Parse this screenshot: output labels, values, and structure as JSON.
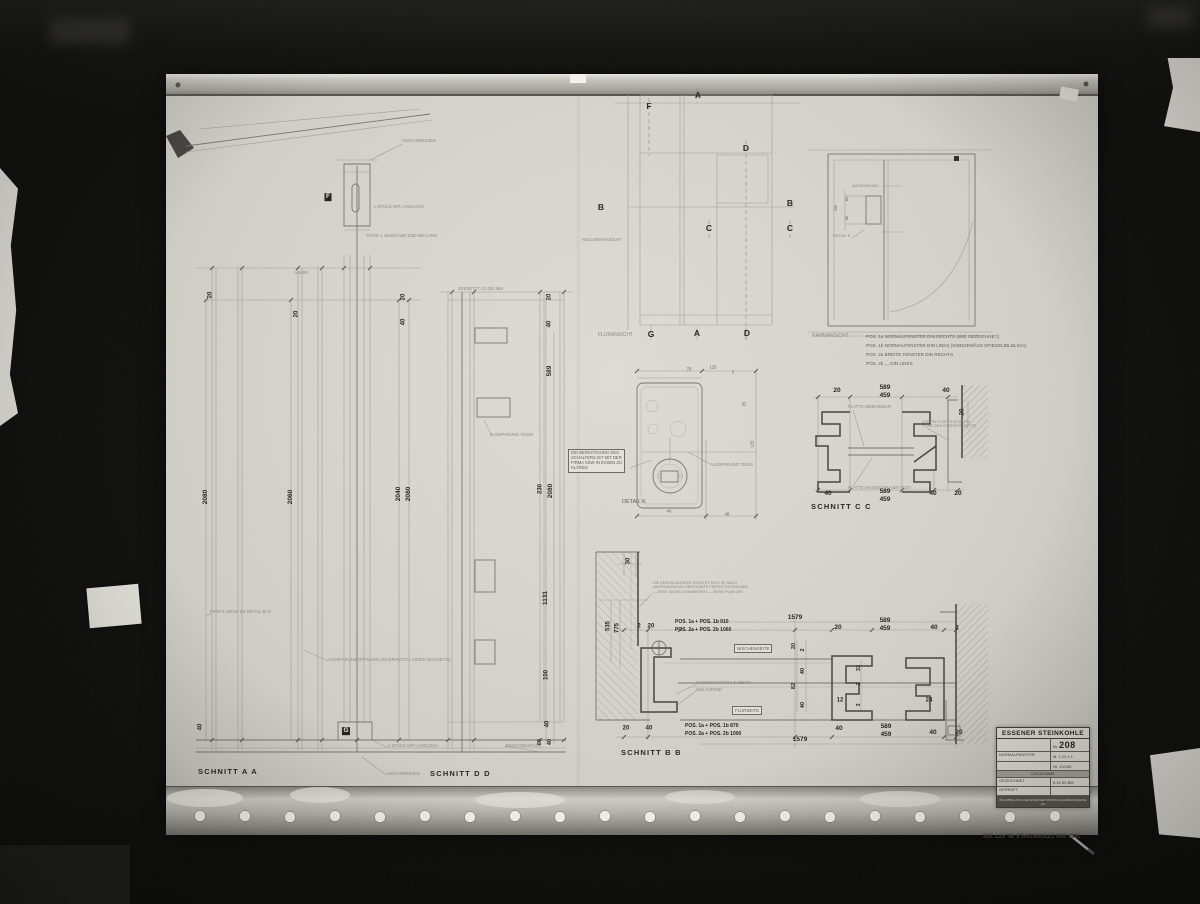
{
  "title_block": {
    "company": "ESSENER STEINKOHLE",
    "number_label": "Nr.",
    "number": "208",
    "name": "NORMALFENSTER",
    "scale": "M. 1:10  1:1",
    "ref": "Nr. 20/158",
    "band": "DATUM        NAME",
    "drawn_label": "GEZEICHNET",
    "drawn_value": "6.10.53   BM",
    "checked_label": "GEPRÜFT",
    "checked_value": "",
    "footer": "BAUABTEILUNG DER ESSENER STEINKOHLENBERGWERKE AG"
  },
  "labels": [
    {
      "t": "SCHNITT  A  A",
      "x": 198,
      "y": 768,
      "s": 7.5,
      "w": 1,
      "ls": 1.2,
      "n": "schnitt-a-a-title"
    },
    {
      "t": "SCHNITT  D  D",
      "x": 430,
      "y": 770,
      "s": 7.5,
      "w": 1,
      "ls": 1.2,
      "n": "schnitt-d-d-title"
    },
    {
      "t": "SCHNITT  B  B",
      "x": 621,
      "y": 749,
      "s": 7.5,
      "w": 1,
      "ls": 1.2,
      "n": "schnitt-b-b-title"
    },
    {
      "t": "SCHNITT  C  C",
      "x": 811,
      "y": 503,
      "s": 7.5,
      "w": 1,
      "ls": 1.2,
      "n": "schnitt-c-c-title"
    },
    {
      "t": "FLURANSICHT",
      "x": 598,
      "y": 333,
      "s": 5,
      "c": "faint",
      "n": "fluransicht-label"
    },
    {
      "t": "RAHMANSICHT",
      "x": 812,
      "y": 334,
      "s": 5,
      "c": "faint",
      "n": "rahmansicht-label"
    },
    {
      "t": "NISCHENANSICHT",
      "x": 582,
      "y": 237,
      "s": 4.5,
      "c": "faint",
      "n": "nischenansicht-label"
    },
    {
      "t": "DETAIL  K",
      "x": 622,
      "y": 499,
      "s": 5.5,
      "c": "mid",
      "n": "detail-k-label"
    },
    {
      "t": "DETAIL K",
      "x": 833,
      "y": 234,
      "s": 4,
      "c": "faint"
    },
    {
      "t": "AUSSPARUNG",
      "x": 852,
      "y": 184,
      "s": 3.8,
      "c": "faint"
    },
    {
      "t": "AUSSPARUNG 75/150",
      "x": 710,
      "y": 463,
      "s": 4.2,
      "c": "faint"
    },
    {
      "t": "AUSSPARUNG 75/150",
      "x": 490,
      "y": 433,
      "s": 4.2,
      "c": "faint"
    },
    {
      "t": "POS. 1a  NORMALFENSTER   DIN RECHTS   (WIE GEZEICHNET)",
      "x": 866,
      "y": 334,
      "s": 4.6,
      "c": "mid"
    },
    {
      "t": "POS. 1b  NORMALFENSTER   DIN LINKS    (SINNGEMÄSS SPIEGELBILDLICH)",
      "x": 866,
      "y": 343,
      "s": 4.6,
      "c": "mid"
    },
    {
      "t": "POS. 2a  BREITE FENSTER   DIN RECHTS",
      "x": 866,
      "y": 352,
      "s": 4.6,
      "c": "mid"
    },
    {
      "t": "POS. 2b       „            „          DIN LINKS",
      "x": 866,
      "y": 361,
      "s": 4.6,
      "c": "mid"
    },
    {
      "t": "DIE BEFESTIGUNG DES\nSCHALTERS IST MIT DER\nFIRMA SSW IN ESSEN ZU\nKLÄREN",
      "x": 568,
      "y": 449,
      "s": 4.2,
      "c": "mid",
      "box": 1,
      "n": "note-befestigung"
    },
    {
      "t": "DIE ANSCHLAGHÖHE RICHTET SICH JE NACH\nANORDNUNG AB OBERKANTE FERTIG FUSSBODEN\n— ERST AM BAU EINMESSEN —   SIEHE PLAN 206",
      "x": 653,
      "y": 581,
      "s": 3.8,
      "c": "faint",
      "n": "note-anschlag"
    },
    {
      "t": "GUMMIDICHTUNG   5-SEITIG",
      "x": 696,
      "y": 681,
      "s": 4.2,
      "c": "faint"
    },
    {
      "t": "UMLAUFEND",
      "x": 696,
      "y": 688,
      "s": 4.2,
      "c": "faint"
    },
    {
      "t": "NISCHENSEITE",
      "x": 734,
      "y": 644,
      "s": 4.4,
      "c": "mid",
      "box": 1
    },
    {
      "t": "FLURSEITE",
      "x": 732,
      "y": 706,
      "s": 4.4,
      "c": "mid",
      "box": 1
    },
    {
      "t": "PLATTE ABNEHMBAR",
      "x": 848,
      "y": 405,
      "s": 4.2,
      "c": "faint"
    },
    {
      "t": "PLATTE ANGESCHRAUBT FEST",
      "x": 848,
      "y": 486,
      "s": 4.2,
      "c": "faint"
    },
    {
      "t": "ASBEST-PLATTE 20 MM IN\nHÖHE DES KÖRPERS (MITTE)",
      "x": 922,
      "y": 420,
      "s": 3.8,
      "c": "faint"
    },
    {
      "t": "ANSCHWEISSEN",
      "x": 402,
      "y": 139,
      "s": 4.2,
      "c": "faint"
    },
    {
      "t": "ANSCHWEISSEN",
      "x": 386,
      "y": 772,
      "s": 4.2,
      "c": "faint"
    },
    {
      "t": "L-STÜCK MIT LANGLOCH",
      "x": 374,
      "y": 205,
      "s": 4.2,
      "c": "faint"
    },
    {
      "t": "STAHL-L 45/45/4 MM    1350 MM LANG",
      "x": 366,
      "y": 234,
      "s": 4.2,
      "c": "faint"
    },
    {
      "t": "L-STÜCK MIT LANGLOCH",
      "x": 388,
      "y": 744,
      "s": 4.2,
      "c": "faint"
    },
    {
      "t": "ZWISCHENSTÜCK",
      "x": 505,
      "y": 744,
      "s": 4.2,
      "c": "faint"
    },
    {
      "t": "VERSETZT CA 300 MM",
      "x": 458,
      "y": 287,
      "s": 4.2,
      "c": "faint"
    },
    {
      "t": "ANKER",
      "x": 294,
      "y": 271,
      "s": 4.2,
      "c": "faint"
    },
    {
      "t": "PROFIL SIEHE ZU DETAIL 45 G",
      "x": 210,
      "y": 610,
      "s": 4.2,
      "c": "faint"
    },
    {
      "t": "AUSSPARUNG ÖFFNUNG UNVERPUTZT LASSEN (BAUSEITS)",
      "x": 328,
      "y": 658,
      "s": 4.2,
      "c": "faint"
    },
    {
      "t": "POS. 1a + POS. 1b    910",
      "x": 675,
      "y": 620,
      "s": 5,
      "w": 1
    },
    {
      "t": "POS. 2a + POS. 2b   1060",
      "x": 675,
      "y": 628,
      "s": 5,
      "w": 1
    },
    {
      "t": "POS. 1a + POS. 1b    870",
      "x": 685,
      "y": 724,
      "s": 5,
      "w": 1
    },
    {
      "t": "POS. 2a + POS. 2b   1000",
      "x": 685,
      "y": 732,
      "s": 5,
      "w": 1
    },
    {
      "t": "2080",
      "x": 206,
      "y": 497,
      "s": 6.5,
      "w": 1,
      "ctr": 1,
      "r": -90
    },
    {
      "t": "2060",
      "x": 291,
      "y": 497,
      "s": 6.5,
      "w": 1,
      "ctr": 1,
      "r": -90
    },
    {
      "t": "2040",
      "x": 399,
      "y": 494,
      "s": 6.5,
      "w": 1,
      "ctr": 1,
      "r": -90
    },
    {
      "t": "2080",
      "x": 409,
      "y": 494,
      "s": 6.5,
      "w": 1,
      "ctr": 1,
      "r": -90
    },
    {
      "t": "20",
      "x": 211,
      "y": 295,
      "s": 6,
      "w": 1,
      "ctr": 1,
      "r": -90
    },
    {
      "t": "20",
      "x": 297,
      "y": 314,
      "s": 6,
      "w": 1,
      "ctr": 1,
      "r": -90
    },
    {
      "t": "20",
      "x": 404,
      "y": 297,
      "s": 6,
      "w": 1,
      "ctr": 1,
      "r": -90
    },
    {
      "t": "40",
      "x": 404,
      "y": 322,
      "s": 6,
      "w": 1,
      "ctr": 1,
      "r": -90
    },
    {
      "t": "40",
      "x": 201,
      "y": 727,
      "s": 6,
      "w": 1,
      "ctr": 1,
      "r": -90
    },
    {
      "t": "20",
      "x": 550,
      "y": 297,
      "s": 6,
      "w": 1,
      "ctr": 1,
      "r": -90
    },
    {
      "t": "40",
      "x": 550,
      "y": 324,
      "s": 6,
      "w": 1,
      "ctr": 1,
      "r": -90
    },
    {
      "t": "589",
      "x": 550,
      "y": 371,
      "s": 6.5,
      "w": 1,
      "ctr": 1,
      "r": -90
    },
    {
      "t": "230",
      "x": 541,
      "y": 489,
      "s": 6,
      "w": 1,
      "ctr": 1,
      "r": -90
    },
    {
      "t": "2080",
      "x": 551,
      "y": 491,
      "s": 6.5,
      "w": 1,
      "ctr": 1,
      "r": -90
    },
    {
      "t": "1131",
      "x": 546,
      "y": 598,
      "s": 6.5,
      "w": 1,
      "ctr": 1,
      "r": -90
    },
    {
      "t": "100",
      "x": 547,
      "y": 675,
      "s": 6,
      "w": 1,
      "ctr": 1,
      "r": -90
    },
    {
      "t": "40",
      "x": 548,
      "y": 724,
      "s": 6,
      "w": 1,
      "ctr": 1,
      "r": -90
    },
    {
      "t": "60",
      "x": 540,
      "y": 742,
      "s": 5.5,
      "w": 1,
      "ctr": 1,
      "r": -90
    },
    {
      "t": "40",
      "x": 550,
      "y": 742,
      "s": 5.5,
      "w": 1,
      "ctr": 1,
      "r": -90
    },
    {
      "t": "535",
      "x": 609,
      "y": 626,
      "s": 6,
      "w": 1,
      "ctr": 1,
      "r": -90
    },
    {
      "t": "775",
      "x": 618,
      "y": 628,
      "s": 6,
      "w": 1,
      "ctr": 1,
      "r": -90
    },
    {
      "t": "30",
      "x": 629,
      "y": 561,
      "s": 6,
      "w": 1,
      "ctr": 1,
      "r": -90
    },
    {
      "t": "20",
      "x": 837,
      "y": 391,
      "s": 6.5,
      "w": 1,
      "ctr": 1
    },
    {
      "t": "589",
      "x": 885,
      "y": 388,
      "s": 6.5,
      "w": 1,
      "ctr": 1
    },
    {
      "t": "459",
      "x": 885,
      "y": 396,
      "s": 6.5,
      "w": 1,
      "ctr": 1
    },
    {
      "t": "40",
      "x": 946,
      "y": 391,
      "s": 6.5,
      "w": 1,
      "ctr": 1
    },
    {
      "t": "20",
      "x": 963,
      "y": 412,
      "s": 6,
      "w": 1,
      "ctr": 1,
      "r": -90
    },
    {
      "t": "40",
      "x": 828,
      "y": 494,
      "s": 6.5,
      "w": 1,
      "ctr": 1
    },
    {
      "t": "589",
      "x": 885,
      "y": 492,
      "s": 6.5,
      "w": 1,
      "ctr": 1
    },
    {
      "t": "459",
      "x": 885,
      "y": 500,
      "s": 6.5,
      "w": 1,
      "ctr": 1
    },
    {
      "t": "40",
      "x": 933,
      "y": 494,
      "s": 6.5,
      "w": 1,
      "ctr": 1
    },
    {
      "t": "20",
      "x": 958,
      "y": 494,
      "s": 6.5,
      "w": 1,
      "ctr": 1
    },
    {
      "t": "2",
      "x": 639,
      "y": 627,
      "s": 6,
      "w": 1,
      "ctr": 1
    },
    {
      "t": "20",
      "x": 651,
      "y": 627,
      "s": 6,
      "w": 1,
      "ctr": 1
    },
    {
      "t": "1579",
      "x": 795,
      "y": 618,
      "s": 6.5,
      "w": 1,
      "ctr": 1
    },
    {
      "t": "20",
      "x": 838,
      "y": 628,
      "s": 6.5,
      "w": 1,
      "ctr": 1
    },
    {
      "t": "589",
      "x": 885,
      "y": 621,
      "s": 6.5,
      "w": 1,
      "ctr": 1
    },
    {
      "t": "459",
      "x": 885,
      "y": 629,
      "s": 6.5,
      "w": 1,
      "ctr": 1
    },
    {
      "t": "40",
      "x": 934,
      "y": 628,
      "s": 6.5,
      "w": 1,
      "ctr": 1
    },
    {
      "t": "2",
      "x": 957,
      "y": 629,
      "s": 6,
      "w": 1,
      "ctr": 1
    },
    {
      "t": "20",
      "x": 794,
      "y": 646,
      "s": 5.5,
      "w": 1,
      "ctr": 1,
      "r": -90
    },
    {
      "t": "2",
      "x": 803,
      "y": 650,
      "s": 5.5,
      "w": 1,
      "ctr": 1,
      "r": -90
    },
    {
      "t": "40",
      "x": 803,
      "y": 671,
      "s": 5.5,
      "w": 1,
      "ctr": 1,
      "r": -90
    },
    {
      "t": "82",
      "x": 794,
      "y": 686,
      "s": 5.5,
      "w": 1,
      "ctr": 1,
      "r": -90
    },
    {
      "t": "40",
      "x": 803,
      "y": 705,
      "s": 5.5,
      "w": 1,
      "ctr": 1,
      "r": -90
    },
    {
      "t": "33",
      "x": 859,
      "y": 668,
      "s": 5.5,
      "w": 1,
      "ctr": 1,
      "r": -90
    },
    {
      "t": "2",
      "x": 859,
      "y": 684,
      "s": 5.5,
      "w": 1,
      "ctr": 1,
      "r": -90
    },
    {
      "t": "3",
      "x": 859,
      "y": 705,
      "s": 5.5,
      "w": 1,
      "ctr": 1,
      "r": -90
    },
    {
      "t": "12",
      "x": 840,
      "y": 701,
      "s": 6,
      "w": 1,
      "ctr": 1
    },
    {
      "t": "24",
      "x": 929,
      "y": 701,
      "s": 6,
      "w": 1,
      "ctr": 1
    },
    {
      "t": "20",
      "x": 626,
      "y": 729,
      "s": 6,
      "w": 1,
      "ctr": 1
    },
    {
      "t": "40",
      "x": 649,
      "y": 729,
      "s": 6,
      "w": 1,
      "ctr": 1
    },
    {
      "t": "1579",
      "x": 800,
      "y": 740,
      "s": 6.5,
      "w": 1,
      "ctr": 1
    },
    {
      "t": "40",
      "x": 839,
      "y": 729,
      "s": 6.5,
      "w": 1,
      "ctr": 1
    },
    {
      "t": "589",
      "x": 886,
      "y": 727,
      "s": 6.5,
      "w": 1,
      "ctr": 1
    },
    {
      "t": "459",
      "x": 886,
      "y": 735,
      "s": 6.5,
      "w": 1,
      "ctr": 1
    },
    {
      "t": "40",
      "x": 933,
      "y": 733,
      "s": 6.5,
      "w": 1,
      "ctr": 1
    },
    {
      "t": "20",
      "x": 959,
      "y": 733,
      "s": 6.5,
      "w": 1,
      "ctr": 1
    },
    {
      "t": "125",
      "x": 713,
      "y": 368,
      "s": 4.2,
      "c": "mid",
      "ctr": 1
    },
    {
      "t": "75",
      "x": 689,
      "y": 370,
      "s": 4.2,
      "c": "mid",
      "ctr": 1
    },
    {
      "t": "2",
      "x": 733,
      "y": 373,
      "s": 4.2,
      "c": "mid",
      "ctr": 1
    },
    {
      "t": "40",
      "x": 669,
      "y": 512,
      "s": 4.2,
      "c": "mid",
      "ctr": 1
    },
    {
      "t": "40",
      "x": 727,
      "y": 515,
      "s": 4.2,
      "c": "mid",
      "ctr": 1
    },
    {
      "t": "25",
      "x": 745,
      "y": 404,
      "s": 4.2,
      "c": "mid",
      "ctr": 1,
      "r": -90
    },
    {
      "t": "120",
      "x": 753,
      "y": 444,
      "s": 4.2,
      "c": "mid",
      "ctr": 1,
      "r": -90
    },
    {
      "t": "200",
      "x": 836,
      "y": 208,
      "s": 3.8,
      "c": "mid",
      "ctr": 1,
      "r": -90
    },
    {
      "t": "60",
      "x": 847,
      "y": 199,
      "s": 3.8,
      "c": "mid",
      "ctr": 1,
      "r": -90
    },
    {
      "t": "60",
      "x": 847,
      "y": 218,
      "s": 3.8,
      "c": "mid",
      "ctr": 1,
      "r": -90
    },
    {
      "t": "A",
      "x": 698,
      "y": 95,
      "s": 8.5,
      "w": 1,
      "ctr": 1,
      "n": "section-letter"
    },
    {
      "t": "F",
      "x": 649,
      "y": 106,
      "s": 8.5,
      "w": 1,
      "ctr": 1,
      "n": "section-letter"
    },
    {
      "t": "D",
      "x": 746,
      "y": 148,
      "s": 8.5,
      "w": 1,
      "ctr": 1,
      "n": "section-letter"
    },
    {
      "t": "B",
      "x": 601,
      "y": 207,
      "s": 8.5,
      "w": 1,
      "ctr": 1,
      "n": "section-letter"
    },
    {
      "t": "B",
      "x": 790,
      "y": 203,
      "s": 8.5,
      "w": 1,
      "ctr": 1,
      "n": "section-letter"
    },
    {
      "t": "C",
      "x": 709,
      "y": 228,
      "s": 8.5,
      "w": 1,
      "ctr": 1,
      "n": "section-letter"
    },
    {
      "t": "C",
      "x": 790,
      "y": 228,
      "s": 8.5,
      "w": 1,
      "ctr": 1,
      "n": "section-letter"
    },
    {
      "t": "G",
      "x": 651,
      "y": 334,
      "s": 8.5,
      "w": 1,
      "ctr": 1,
      "n": "section-letter"
    },
    {
      "t": "A",
      "x": 697,
      "y": 333,
      "s": 8.5,
      "w": 1,
      "ctr": 1,
      "n": "section-letter"
    },
    {
      "t": "D",
      "x": 747,
      "y": 333,
      "s": 8.5,
      "w": 1,
      "ctr": 1,
      "n": "section-letter"
    },
    {
      "t": "F",
      "x": 328,
      "y": 197,
      "s": 6.5,
      "c": "inv",
      "ctr": 1,
      "n": "marker-f"
    },
    {
      "t": "G",
      "x": 346,
      "y": 731,
      "s": 6.5,
      "c": "inv",
      "ctr": 1,
      "n": "marker-g"
    },
    {
      "t": "7856 868   STEINKOHLE   BLATT  208",
      "x": 1032,
      "y": 834,
      "s": 6,
      "w": 1,
      "ctr": 1,
      "r": 180,
      "c": "stamp",
      "n": "edge-stamp"
    }
  ]
}
